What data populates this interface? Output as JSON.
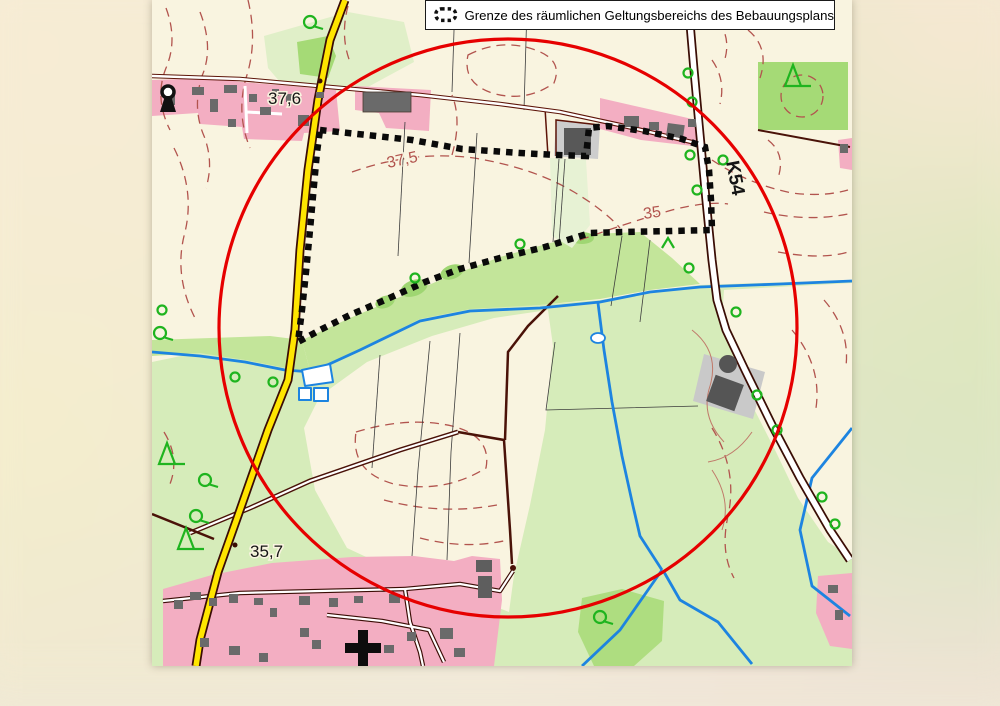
{
  "legend": {
    "symbol": "dotted-boundary-icon",
    "text": "Grenze des räumlichen Geltungsbereichs des Bebauungsplans"
  },
  "map": {
    "spot_heights": [
      {
        "text": "37,6"
      },
      {
        "text": "35,7"
      }
    ],
    "contour_labels": [
      {
        "text": "37,5"
      },
      {
        "text": "35"
      }
    ],
    "road_label": {
      "text": "K54"
    }
  },
  "colors": {
    "plan_boundary": "#0a0a0a",
    "highlight_circle": "#e60000",
    "main_road_fill": "#ffe500",
    "road_casing": "#3a0d05",
    "water": "#1d84e0",
    "contour": "#b2544e",
    "settlement": "#f3aec2",
    "building": "#6a6a6a",
    "woodland": "#a5da76",
    "meadow": "#d6ecba",
    "tree_symbol": "#1fb41f",
    "map_background": "#f9f4e0"
  }
}
